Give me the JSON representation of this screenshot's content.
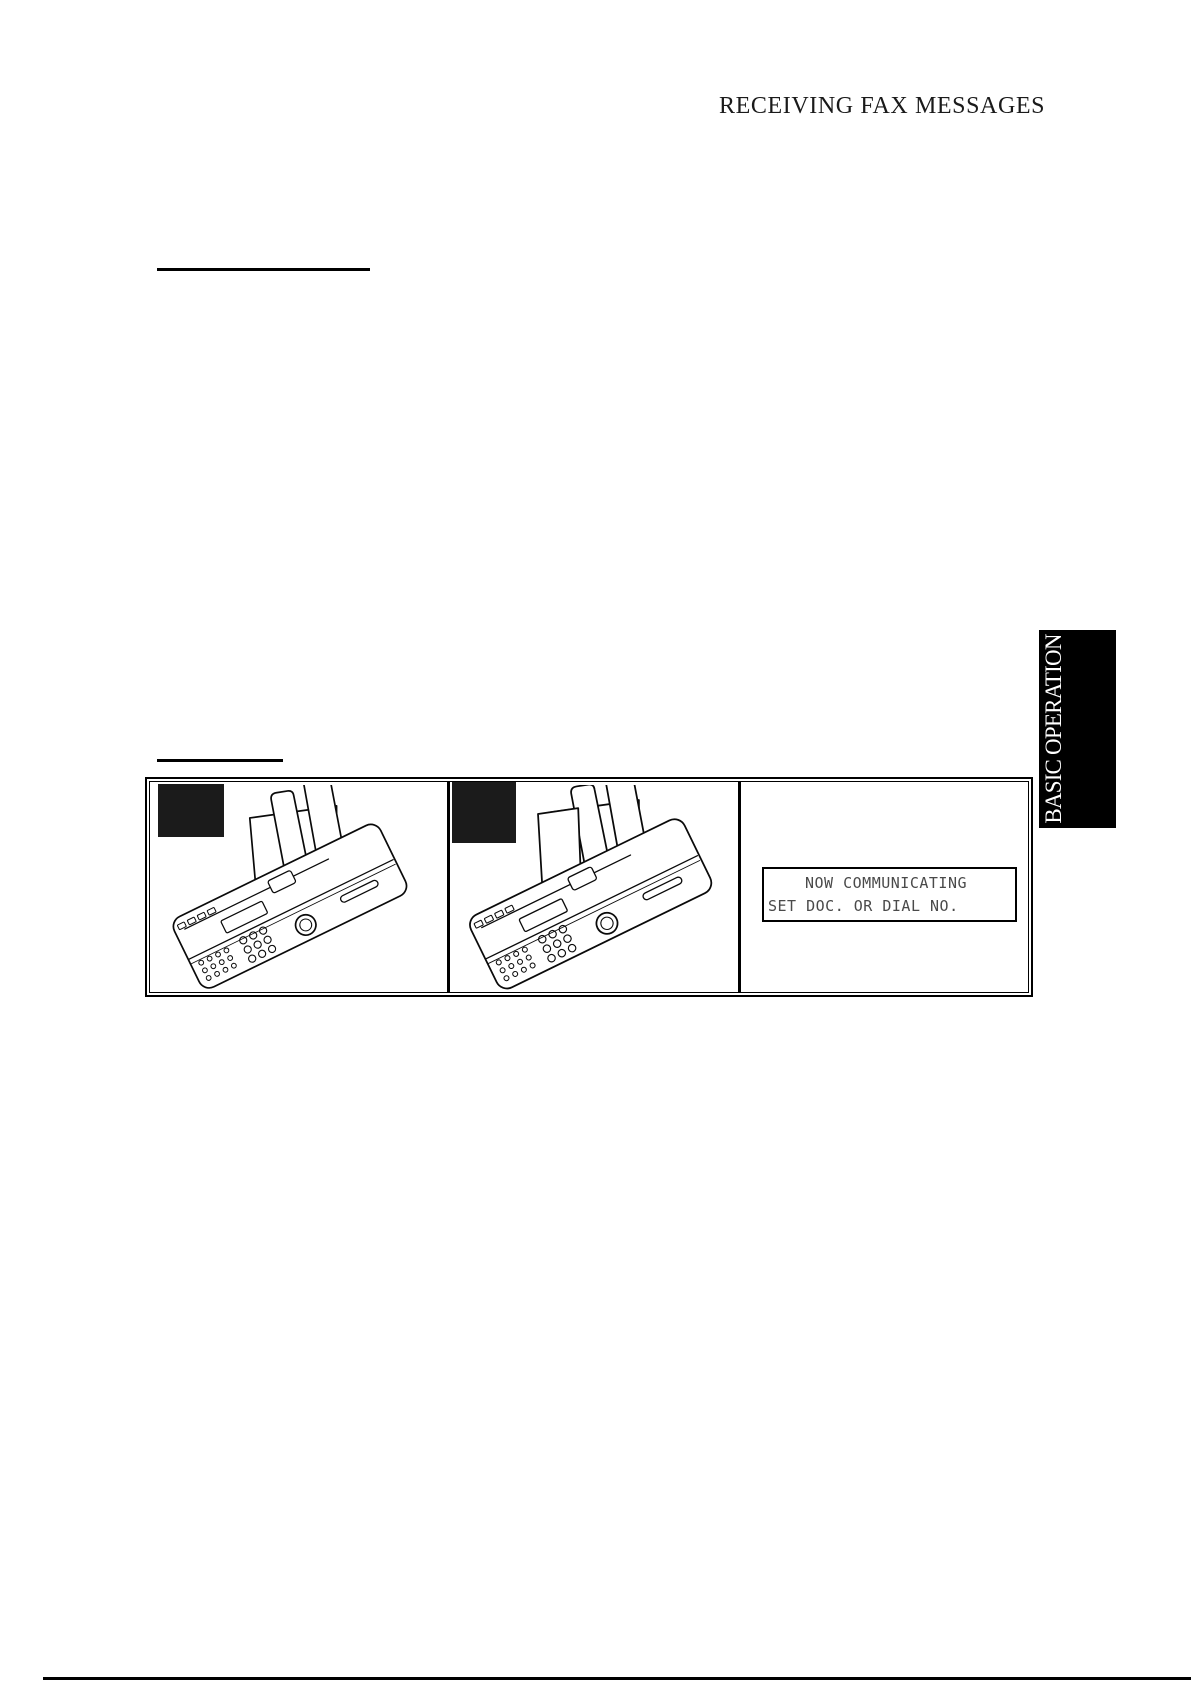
{
  "page_title": "RECEIVING FAX MESSAGES",
  "side_tab": {
    "label": "BASIC OPERATION"
  },
  "figure": {
    "panel1_illustration": "fax-machine",
    "panel2_illustration": "fax-machine-with-document",
    "step_box_1": "",
    "step_box_2": "",
    "lcd": {
      "line1": "NOW COMMUNICATING",
      "line2": "SET DOC. OR DIAL NO."
    }
  },
  "colors": {
    "page_bg": "#ffffff",
    "ink": "#000000",
    "step_box_fill": "#1b1b1b",
    "lcd_text": "#4a4a4a",
    "tab_bg": "#000000",
    "tab_text": "#ffffff"
  }
}
